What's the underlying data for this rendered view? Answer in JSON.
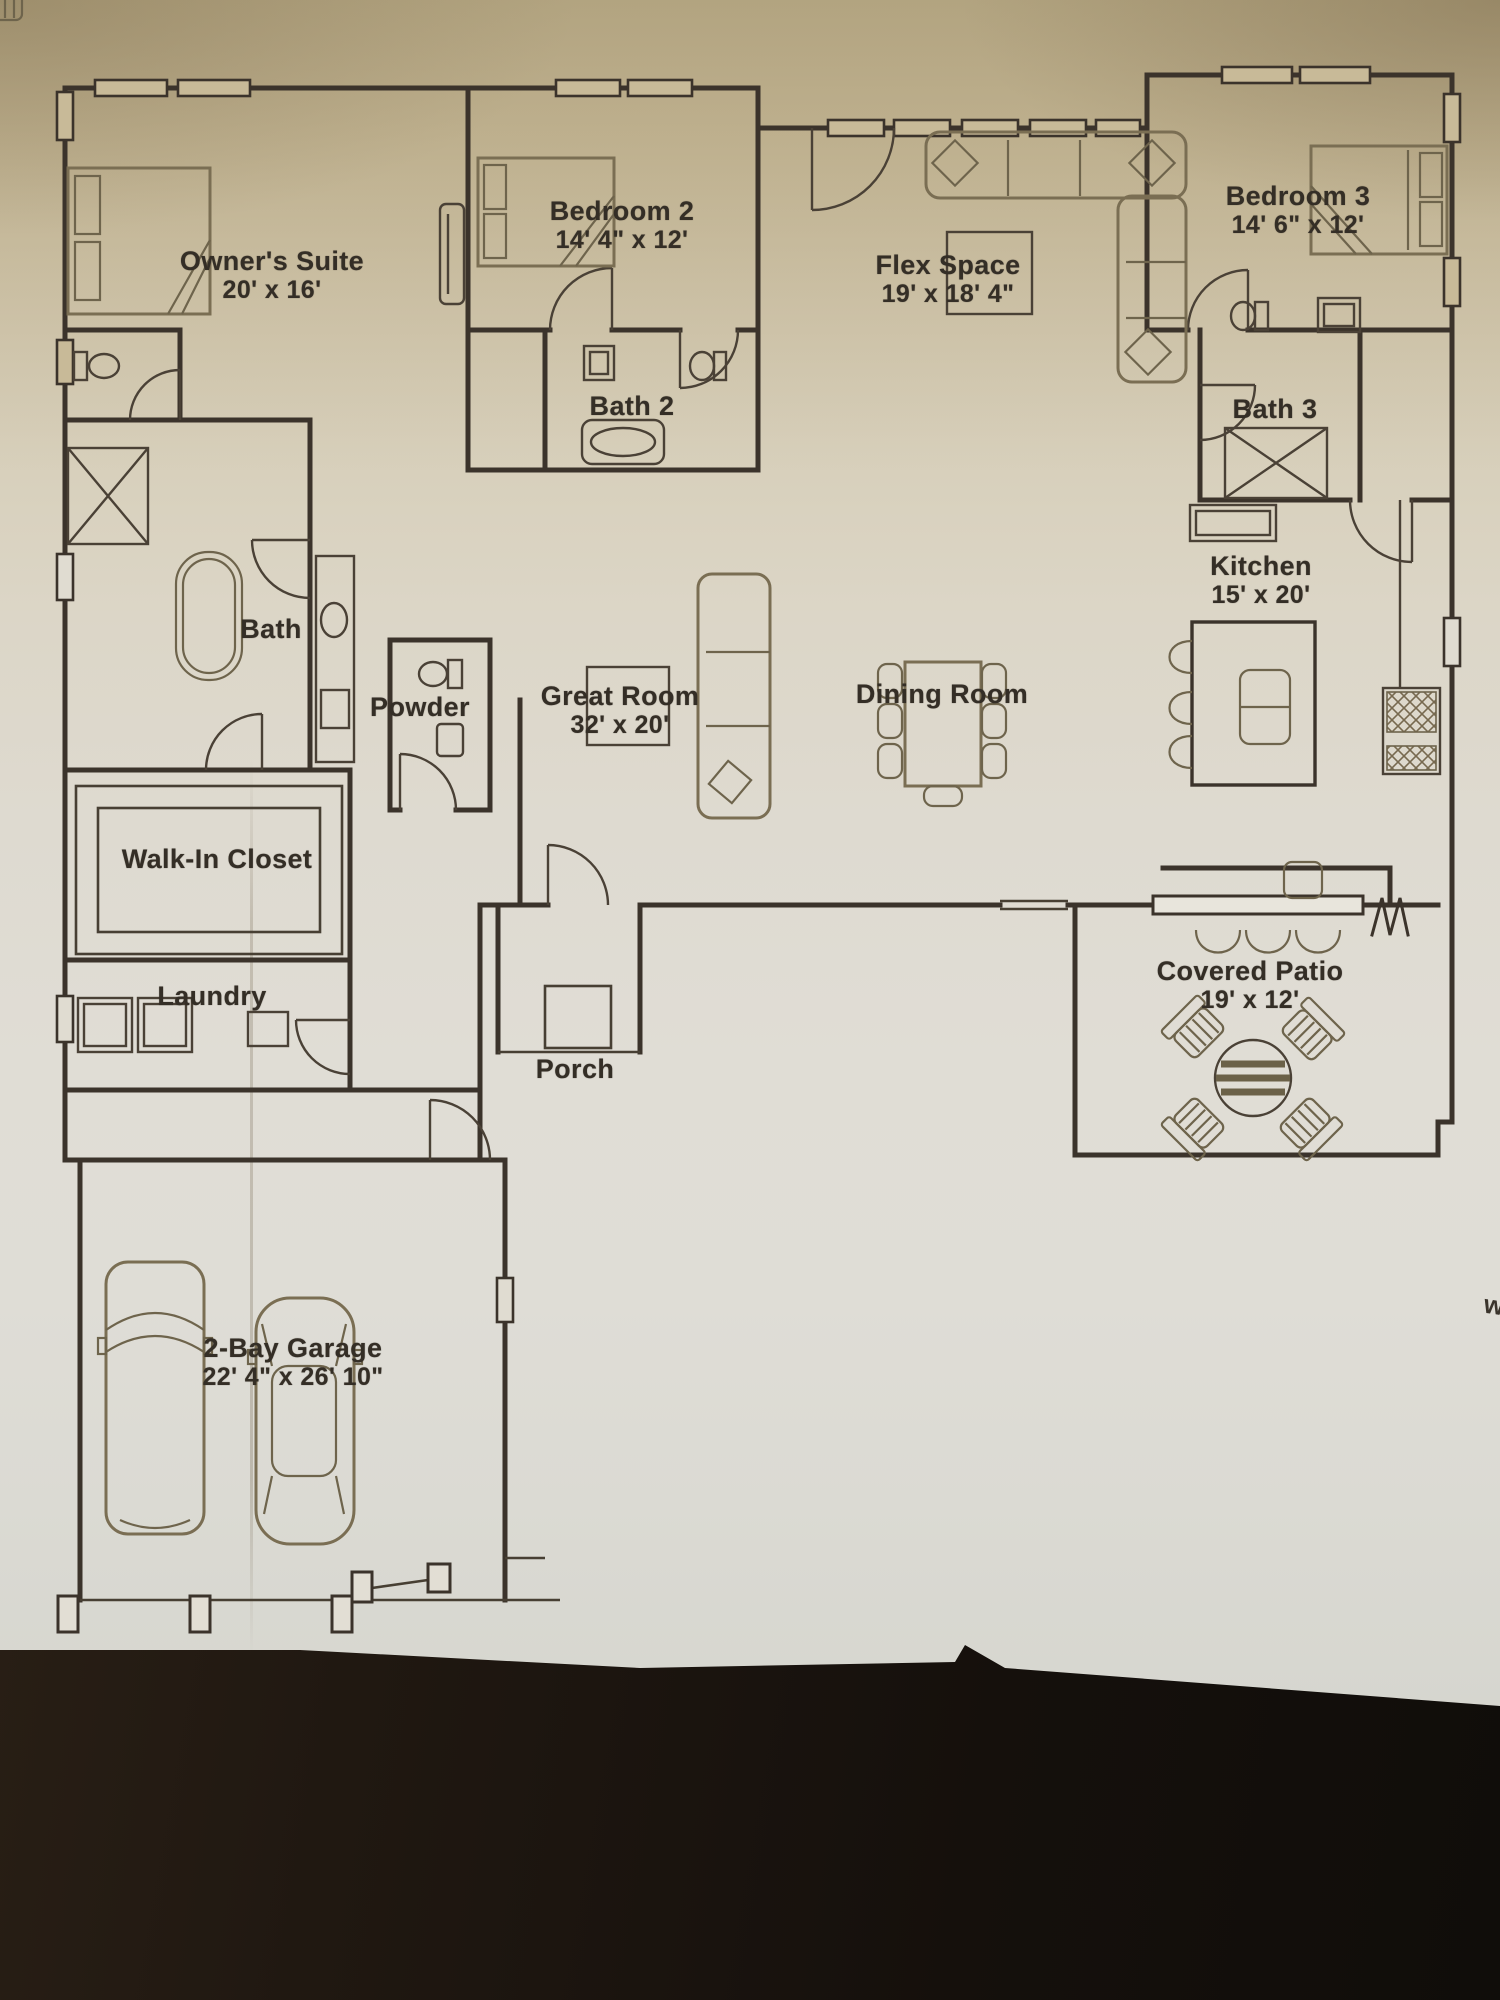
{
  "photo": {
    "background_color": "#1c1510",
    "paper_top_color": "#c3b592",
    "paper_bottom_color": "#dedad2",
    "ink_color": "#3b332b",
    "furniture_color": "#7a6e53"
  },
  "plan": {
    "rooms": [
      {
        "id": "owners-suite",
        "name": "Owner's Suite",
        "dims": "20' x 16'"
      },
      {
        "id": "bedroom-2",
        "name": "Bedroom 2",
        "dims": "14' 4\" x 12'"
      },
      {
        "id": "flex-space",
        "name": "Flex Space",
        "dims": "19' x 18' 4\""
      },
      {
        "id": "bedroom-3",
        "name": "Bedroom 3",
        "dims": "14' 6\" x 12'"
      },
      {
        "id": "bath-2",
        "name": "Bath 2",
        "dims": ""
      },
      {
        "id": "bath-3",
        "name": "Bath 3",
        "dims": ""
      },
      {
        "id": "kitchen",
        "name": "Kitchen",
        "dims": "15' x 20'"
      },
      {
        "id": "bath",
        "name": "Bath",
        "dims": ""
      },
      {
        "id": "powder",
        "name": "Powder",
        "dims": ""
      },
      {
        "id": "great-room",
        "name": "Great Room",
        "dims": "32' x 20'"
      },
      {
        "id": "dining-room",
        "name": "Dining Room",
        "dims": ""
      },
      {
        "id": "walk-in-closet",
        "name": "Walk-In Closet",
        "dims": ""
      },
      {
        "id": "laundry",
        "name": "Laundry",
        "dims": ""
      },
      {
        "id": "porch",
        "name": "Porch",
        "dims": ""
      },
      {
        "id": "covered-patio",
        "name": "Covered Patio",
        "dims": "19' x 12'"
      },
      {
        "id": "garage",
        "name": "2-Bay Garage",
        "dims": "22' 4\" x 26' 10\""
      }
    ],
    "edge_mark": "w"
  }
}
